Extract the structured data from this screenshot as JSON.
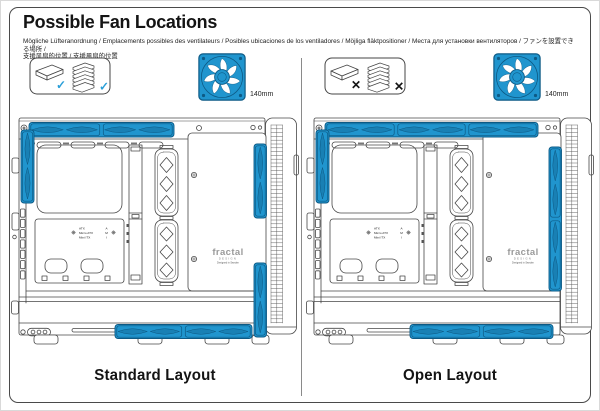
{
  "page": {
    "title": "Possible Fan Locations",
    "subtitle_line1": "Mögliche Lüfteranordnung / Emplacements possibles des ventilateurs / Posibles ubicaciones de los ventiladores / Möjliga fläktpositioner / Места для установки вентиляторов / ファンを設置できる場所 /",
    "subtitle_line2": "支援风扇的位置 / 支援風扇的位置"
  },
  "colors": {
    "fan_blue": "#2095ce",
    "fan_blue_dark": "#0d5a85",
    "check_blue": "#2a9fd8",
    "cross_black": "#141414",
    "line_gray": "#474747"
  },
  "layouts": [
    {
      "key": "standard",
      "label": "Standard Layout",
      "fan_size_label": "140mm",
      "drive_mark": "✓",
      "fan_zones": {
        "top": 2,
        "rear": 1,
        "front": 2,
        "bottom": 2
      }
    },
    {
      "key": "open",
      "label": "Open Layout",
      "fan_size_label": "140mm",
      "drive_mark": "✕",
      "fan_zones": {
        "top": 3,
        "rear": 1,
        "front": 2,
        "bottom": 2
      }
    }
  ],
  "diagram_text": {
    "mobo_rows": [
      {
        "size": "ATX",
        "key": "A"
      },
      {
        "size": "Micro ATX",
        "key": "M"
      },
      {
        "size": "Mini ITX",
        "key": "I"
      }
    ],
    "brand": "fractal",
    "brand_sub": "DESIGN",
    "brand_tagline": "Designed in Sweden"
  }
}
